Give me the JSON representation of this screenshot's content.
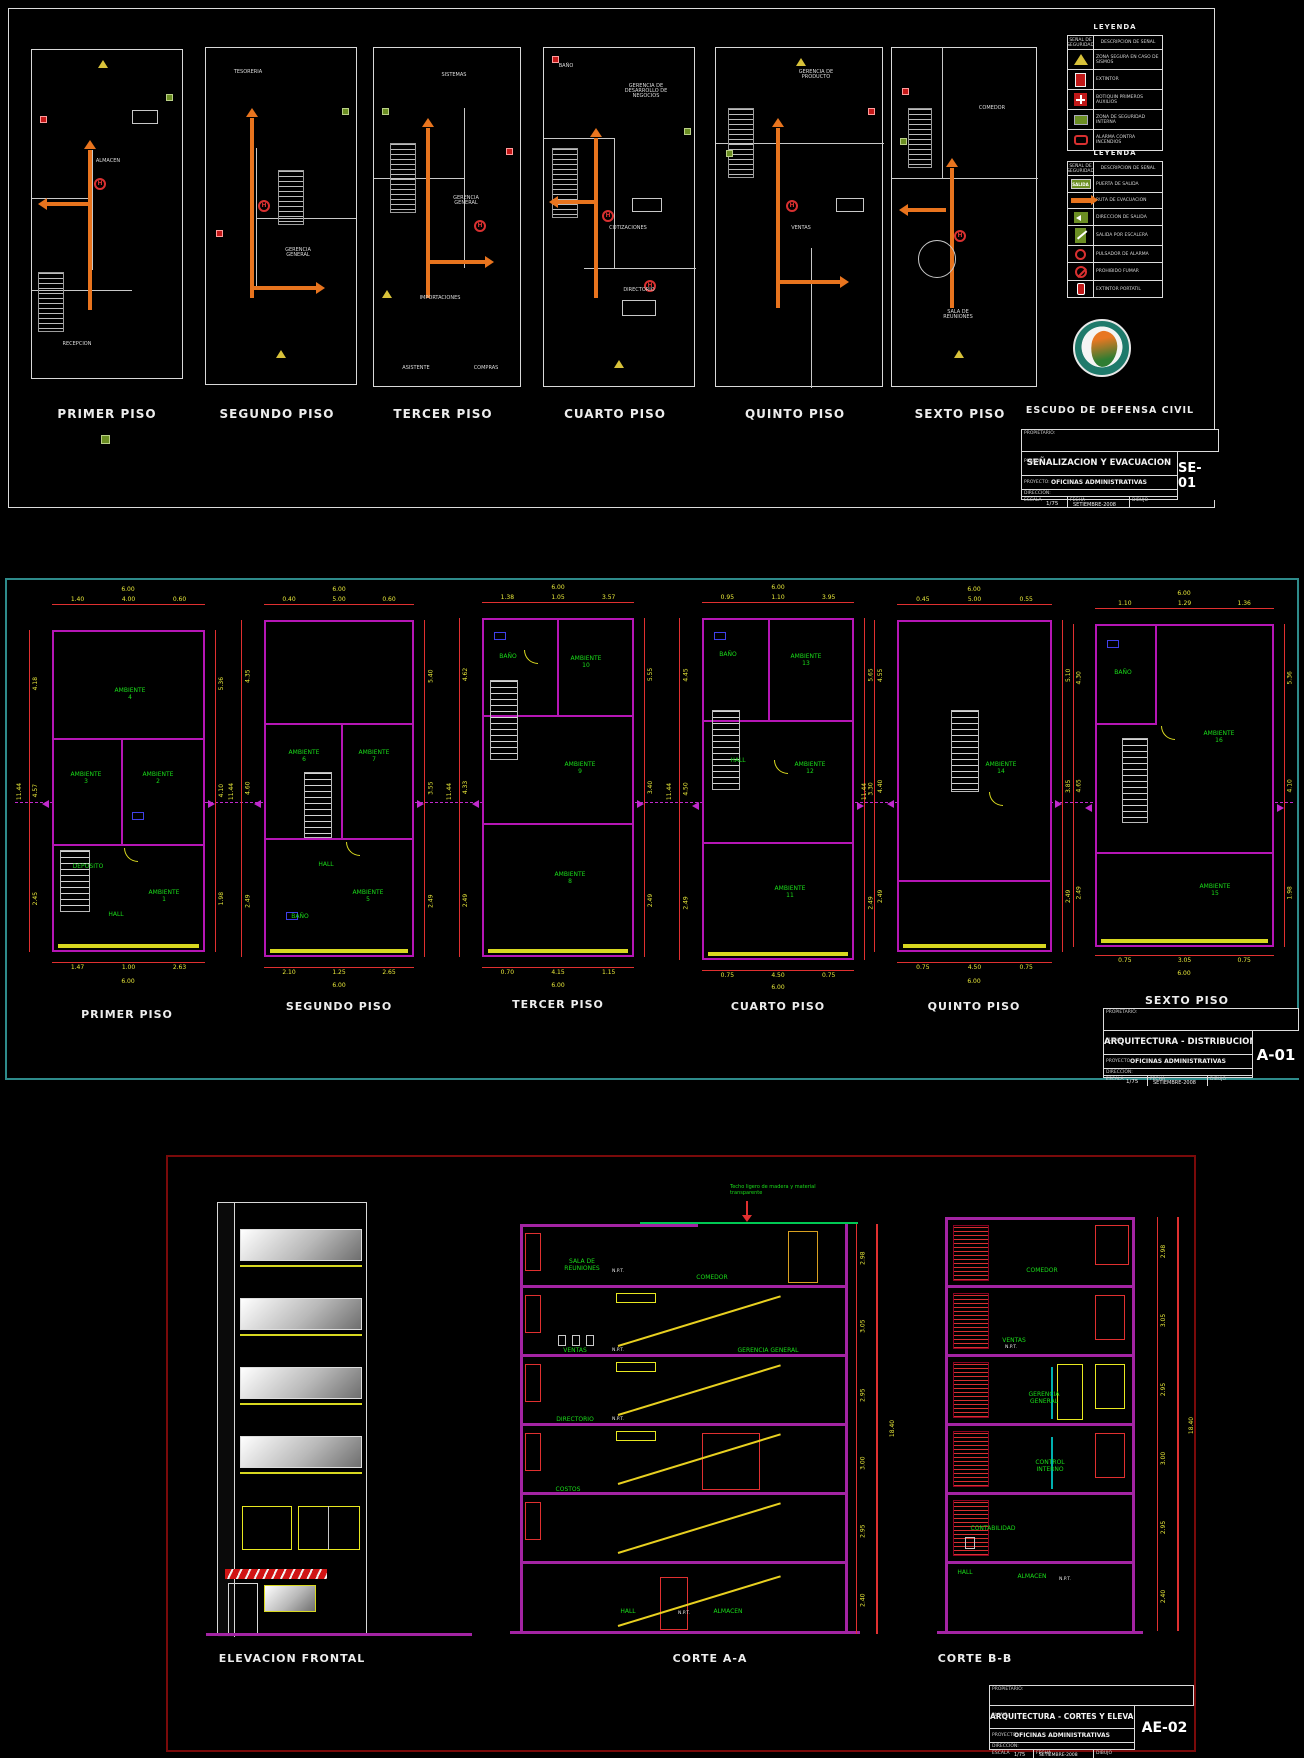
{
  "shared": {
    "floor_titles": [
      "PRIMER PISO",
      "SEGUNDO PISO",
      "TERCER PISO",
      "CUARTO PISO",
      "QUINTO PISO",
      "SEXTO PISO"
    ],
    "tb": {
      "propietario_label": "PROPIETARIO:",
      "plano_label": "PLANO:",
      "proyecto_label": "PROYECTO:",
      "direccion_label": "DIRECCION:",
      "escala_label": "ESCALA",
      "escala_value": "1/75",
      "fecha_label": "FECHA",
      "fecha_value": "SETIEMBRE-2008",
      "dibujo_label": "DIBUJO",
      "proyecto_value": "OFICINAS ADMINISTRATIVAS"
    }
  },
  "sheet1": {
    "code": "SE-01",
    "plano": "SEÑALIZACION Y EVACUACION",
    "h_label": "H",
    "escudo_label": "ESCUDO DE DEFENSA CIVIL",
    "plans": [
      {
        "rooms": [
          "ALMACEN",
          "RECEPCION"
        ]
      },
      {
        "rooms": [
          "TESORERIA",
          "GERENCIA GENERAL"
        ]
      },
      {
        "rooms": [
          "SISTEMAS",
          "GERENCIA GENERAL",
          "IMPORTACIONES",
          "ASISTENTE",
          "COMPRAS"
        ]
      },
      {
        "rooms": [
          "BAÑO",
          "GERENCIA DE DESARROLLO DE NEGOCIOS",
          "COTIZACIONES",
          "DIRECTORIO"
        ]
      },
      {
        "rooms": [
          "GERENCIA DE PRODUCTO",
          "VENTAS"
        ]
      },
      {
        "rooms": [
          "COMEDOR",
          "SALA DE REUNIONES"
        ]
      }
    ],
    "legend_evac": {
      "title": "LEYENDA",
      "col_symbol": "SEÑAL DE SEGURIDAD",
      "col_desc": "DESCRIPCION DE SEÑAL",
      "rows": [
        {
          "desc": "ZONA SEGURA EN CASO DE SISMOS"
        },
        {
          "desc": "EXTINTOR"
        },
        {
          "desc": "BOTIQUIN PRIMEROS AUXILIOS"
        },
        {
          "desc": "ZONA DE SEGURIDAD INTERNA"
        },
        {
          "desc": "ALARMA CONTRA INCENDIOS"
        }
      ]
    },
    "legend_senal": {
      "title": "LEYENDA",
      "col_symbol": "SEÑAL DE SEGURIDAD",
      "col_desc": "DESCRIPCION DE SEÑAL",
      "salida_label": "SALIDA",
      "rows": [
        {
          "desc": "PUERTA DE SALIDA"
        },
        {
          "desc": "RUTA DE EVACUACION"
        },
        {
          "desc": "DIRECCION DE SALIDA"
        },
        {
          "desc": "SALIDA POR ESCALERA"
        },
        {
          "desc": "PULSADOR DE ALARMA"
        },
        {
          "desc": "PROHIBIDO FUMAR"
        },
        {
          "desc": "EXTINTOR PORTATIL"
        }
      ]
    }
  },
  "sheet2": {
    "code": "A-01",
    "plano": "ARQUITECTURA - DISTRIBUCION",
    "floors": [
      {
        "rooms": [
          "AMBIENTE 4",
          "AMBIENTE 3",
          "AMBIENTE 2",
          "DEPOSITO",
          "HALL",
          "AMBIENTE 1"
        ],
        "dims_top": [
          "1.40",
          "4.00",
          "0.60"
        ],
        "top_total": "6.00",
        "dims_bottom": [
          "1.47",
          "1.00",
          "2.63"
        ],
        "bottom_total": "6.00",
        "dims_left": [
          "4.18",
          "4.57",
          "2.45"
        ],
        "left_total": "11.44",
        "dims_right": [
          "5.36",
          "4.10",
          "1.98"
        ]
      },
      {
        "rooms": [
          "AMBIENTE 6",
          "AMBIENTE 7",
          "HALL",
          "BAÑO",
          "AMBIENTE 5"
        ],
        "dims_top": [
          "0.40",
          "5.00",
          "0.60"
        ],
        "top_total": "6.00",
        "dims_bottom": [
          "2.10",
          "1.25",
          "2.65"
        ],
        "bottom_total": "6.00",
        "dims_left": [
          "4.35",
          "4.60",
          "2.49"
        ],
        "left_total": "11.44",
        "dims_right": [
          "5.40",
          "3.55",
          "2.49"
        ]
      },
      {
        "rooms": [
          "BAÑO",
          "AMBIENTE 10",
          "AMBIENTE 9",
          "AMBIENTE 8"
        ],
        "dims_top": [
          "1.38",
          "1.05",
          "3.57"
        ],
        "top_total": "6.00",
        "dims_bottom": [
          "0.70",
          "4.15",
          "1.15"
        ],
        "bottom_total": "6.00",
        "dims_left": [
          "4.62",
          "4.33",
          "2.49"
        ],
        "left_total": "11.44",
        "dims_right": [
          "5.55",
          "3.40",
          "2.49"
        ]
      },
      {
        "rooms": [
          "BAÑO",
          "AMBIENTE 13",
          "HALL",
          "AMBIENTE 12",
          "AMBIENTE 11"
        ],
        "dims_top": [
          "0.95",
          "1.10",
          "3.95"
        ],
        "top_total": "6.00",
        "dims_bottom": [
          "0.75",
          "4.50",
          "0.75"
        ],
        "bottom_total": "6.00",
        "dims_left": [
          "4.45",
          "4.50",
          "2.49"
        ],
        "left_total": "11.44",
        "dims_right": [
          "5.65",
          "3.30",
          "2.49"
        ]
      },
      {
        "rooms": [
          "AMBIENTE 14"
        ],
        "dims_top": [
          "0.45",
          "5.00",
          "0.55"
        ],
        "top_total": "6.00",
        "dims_bottom": [
          "0.75",
          "4.50",
          "0.75"
        ],
        "bottom_total": "6.00",
        "dims_left": [
          "4.55",
          "4.40",
          "2.49"
        ],
        "left_total": "11.44",
        "dims_right": [
          "5.10",
          "3.85",
          "2.49"
        ]
      },
      {
        "rooms": [
          "BAÑO",
          "AMBIENTE 16",
          "AMBIENTE 15"
        ],
        "dims_top": [
          "1.10",
          "1.29",
          "1.36"
        ],
        "top_total": "6.00",
        "dims_bottom": [
          "0.75",
          "3.05",
          "0.75"
        ],
        "bottom_total": "6.00",
        "dims_left": [
          "4.30",
          "4.65",
          "2.49"
        ],
        "left_total": "11.44",
        "dims_right": [
          "5.36",
          "4.10",
          "1.98"
        ]
      }
    ]
  },
  "sheet3": {
    "code": "AE-02",
    "plano": "ARQUITECTURA - CORTES Y ELEVACION",
    "view_titles": [
      "ELEVACION FRONTAL",
      "CORTE A-A",
      "CORTE B-B"
    ],
    "roof_note": "Techo ligero de madera y material transparente",
    "npt_label": "N.P.T.",
    "corte_a": {
      "sala": "SALA DE REUNIONES",
      "comedor": "COMEDOR",
      "ventas": "VENTAS",
      "gerencia": "GERENCIA GENERAL",
      "directorio": "DIRECTORIO",
      "costos": "COSTOS",
      "hall": "HALL",
      "almacen": "ALMACEN"
    },
    "corte_b": {
      "comedor": "COMEDOR",
      "ventas": "VENTAS",
      "gerencia": "GERENCIA GENERAL",
      "control": "CONTROL INTERNO",
      "contabilidad": "CONTABILIDAD",
      "hall": "HALL",
      "almacen": "ALMACEN"
    },
    "levels": [
      "2.98",
      "3.05",
      "2.95",
      "3.00",
      "2.95",
      "2.40"
    ],
    "level_total": "18.40"
  }
}
